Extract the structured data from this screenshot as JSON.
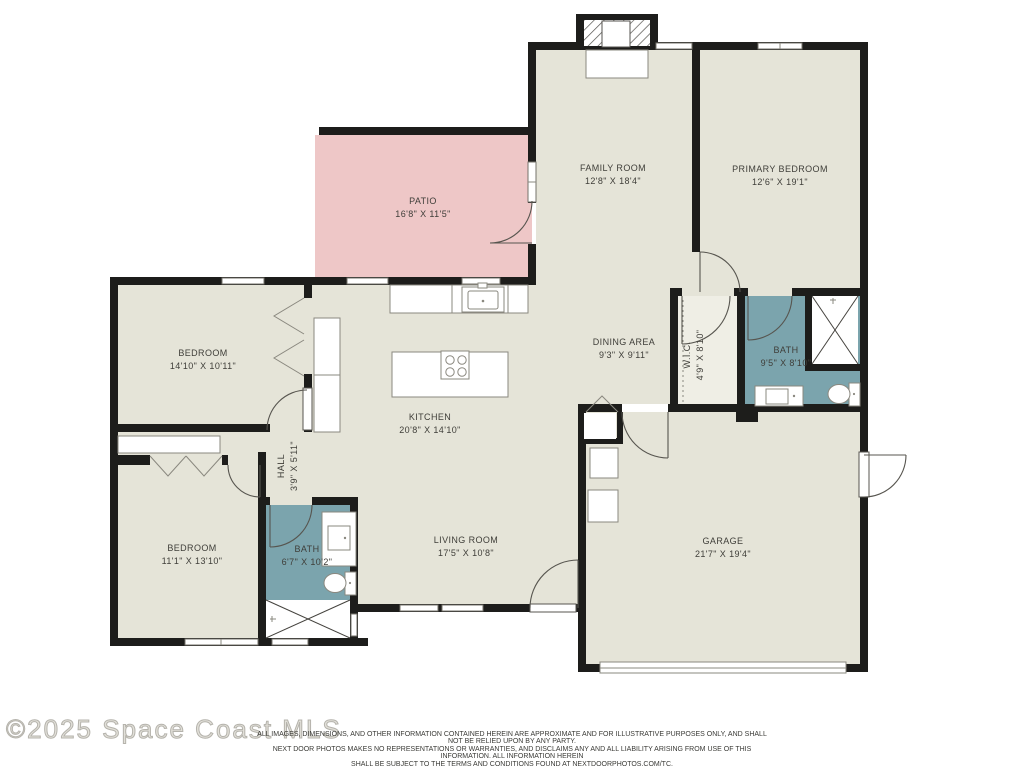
{
  "plan_title": "Residential floor plan",
  "colors": {
    "floor": "#e5e4d8",
    "patio": "#eec7c7",
    "bath": "#7ba4ad",
    "wall": "#1d1d1b",
    "label": "#3f3e39"
  },
  "rooms": {
    "patio": {
      "name": "PATIO",
      "dims": "16'8\" X 11'5\""
    },
    "family_room": {
      "name": "FAMILY ROOM",
      "dims": "12'8\" X 18'4\""
    },
    "primary_bedroom": {
      "name": "PRIMARY BEDROOM",
      "dims": "12'6\" X 19'1\""
    },
    "bedroom_1": {
      "name": "BEDROOM",
      "dims": "14'10\" X 10'11\""
    },
    "dining_area": {
      "name": "DINING AREA",
      "dims": "9'3\" X 9'11\""
    },
    "wic": {
      "name": "W.I.C.",
      "dims": "4'9\" X 8'10\""
    },
    "primary_bath": {
      "name": "BATH",
      "dims": "9'5\" X 8'10\""
    },
    "kitchen": {
      "name": "KITCHEN",
      "dims": "20'8\" X 14'10\""
    },
    "hall": {
      "name": "HALL",
      "dims": "3'9\" X 5'11\""
    },
    "bedroom_2": {
      "name": "BEDROOM",
      "dims": "11'1\" X 13'10\""
    },
    "bath_2": {
      "name": "BATH",
      "dims": "6'7\" X 10'2\""
    },
    "living_room": {
      "name": "LIVING ROOM",
      "dims": "17'5\" X 10'8\""
    },
    "garage": {
      "name": "GARAGE",
      "dims": "21'7\" X 19'4\""
    }
  },
  "icons": [
    "fireplace-icon",
    "cooktop-icon",
    "kitchen-sink-icon",
    "bathroom-vanity-icon",
    "toilet-icon",
    "shower-icon",
    "showerhead-icon",
    "appliance-icon",
    "bifold-door-icon",
    "door-swing-icon",
    "window-icon",
    "garage-door-icon",
    "closet-rod-line"
  ],
  "footer": {
    "watermark": "©2025 Space Coast MLS",
    "disclaimer_line1": "ALL IMAGES, DIMENSIONS, AND OTHER INFORMATION CONTAINED HEREIN ARE APPROXIMATE AND FOR ILLUSTRATIVE PURPOSES ONLY, AND SHALL NOT BE RELIED UPON BY ANY PARTY.",
    "disclaimer_line2": "NEXT DOOR PHOTOS MAKES NO REPRESENTATIONS OR WARRANTIES, AND DISCLAIMS ANY AND ALL LIABILITY ARISING FROM USE OF THIS INFORMATION. ALL INFORMATION HEREIN",
    "disclaimer_line3": "SHALL BE SUBJECT TO THE TERMS AND CONDITIONS FOUND AT NEXTDOORPHOTOS.COM/TC."
  }
}
